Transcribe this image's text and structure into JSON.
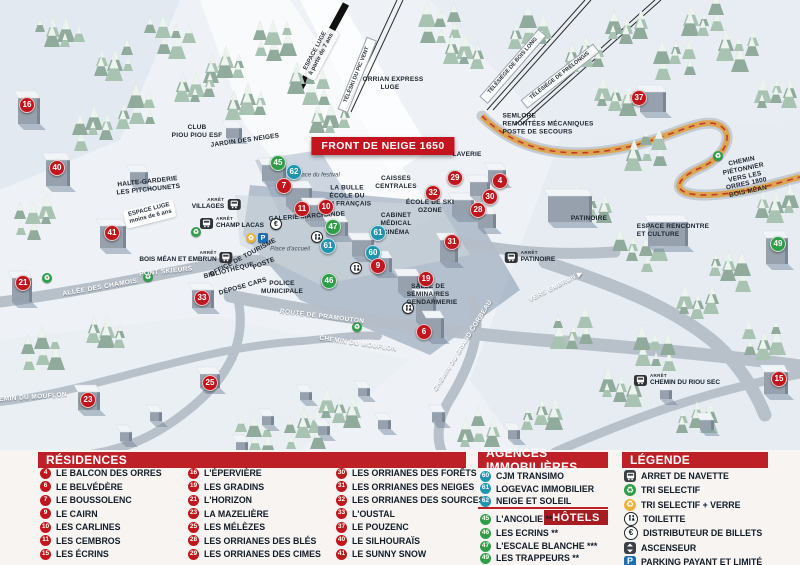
{
  "colors": {
    "red": "#c0161e",
    "green": "#2f9e49",
    "blue": "#2095ae",
    "header_red": "#bd2027",
    "banner_red": "#c41420",
    "parking_blue": "#1e6eb5",
    "trail_orange": "#dfa145"
  },
  "map": {
    "banner": "FRONT DE NEIGE 1650",
    "bus_prefix": "ARRÊT",
    "markers": [
      {
        "n": "16",
        "c": "r",
        "x": 27,
        "y": 105
      },
      {
        "n": "40",
        "c": "r",
        "x": 57,
        "y": 168
      },
      {
        "n": "41",
        "c": "r",
        "x": 112,
        "y": 233
      },
      {
        "n": "21",
        "c": "r",
        "x": 23,
        "y": 283
      },
      {
        "n": "33",
        "c": "r",
        "x": 202,
        "y": 298
      },
      {
        "n": "23",
        "c": "r",
        "x": 88,
        "y": 400
      },
      {
        "n": "25",
        "c": "r",
        "x": 210,
        "y": 383
      },
      {
        "n": "45",
        "c": "g",
        "x": 278,
        "y": 163
      },
      {
        "n": "62",
        "c": "b",
        "x": 294,
        "y": 172
      },
      {
        "n": "7",
        "c": "r",
        "x": 284,
        "y": 186
      },
      {
        "n": "11",
        "c": "r",
        "x": 302,
        "y": 209
      },
      {
        "n": "10",
        "c": "r",
        "x": 326,
        "y": 207
      },
      {
        "n": "47",
        "c": "g",
        "x": 333,
        "y": 227
      },
      {
        "n": "61",
        "c": "b",
        "x": 328,
        "y": 246
      },
      {
        "n": "61",
        "c": "b",
        "x": 378,
        "y": 233
      },
      {
        "n": "60",
        "c": "b",
        "x": 373,
        "y": 253
      },
      {
        "n": "9",
        "c": "r",
        "x": 378,
        "y": 266
      },
      {
        "n": "46",
        "c": "g",
        "x": 329,
        "y": 281
      },
      {
        "n": "19",
        "c": "r",
        "x": 426,
        "y": 279
      },
      {
        "n": "6",
        "c": "r",
        "x": 424,
        "y": 332
      },
      {
        "n": "31",
        "c": "r",
        "x": 452,
        "y": 242
      },
      {
        "n": "28",
        "c": "r",
        "x": 478,
        "y": 210
      },
      {
        "n": "29",
        "c": "r",
        "x": 455,
        "y": 178
      },
      {
        "n": "30",
        "c": "r",
        "x": 490,
        "y": 197
      },
      {
        "n": "4",
        "c": "r",
        "x": 500,
        "y": 181
      },
      {
        "n": "32",
        "c": "r",
        "x": 433,
        "y": 193
      },
      {
        "n": "37",
        "c": "r",
        "x": 639,
        "y": 98
      },
      {
        "n": "49",
        "c": "g",
        "x": 778,
        "y": 244
      },
      {
        "n": "15",
        "c": "r",
        "x": 779,
        "y": 379
      }
    ],
    "labels": [
      {
        "t": "CLUB\nPIOU PIOU ESF",
        "x": 197,
        "y": 132,
        "r": 0,
        "s": "dark"
      },
      {
        "t": "JARDIN DES NEIGES",
        "x": 245,
        "y": 141,
        "r": -8,
        "s": "dark"
      },
      {
        "t": "ESPACE LUGE\nà partir de 7 ans",
        "x": 319,
        "y": 53,
        "r": -62,
        "s": "box"
      },
      {
        "t": "ESPACE LUGE\nmoins de 6 ans",
        "x": 150,
        "y": 214,
        "r": -14,
        "s": "box"
      },
      {
        "t": "L'ORRIAN EXPRESS\nLUGE",
        "x": 390,
        "y": 84,
        "r": 0,
        "s": "dark"
      },
      {
        "t": "TÉLÉSKI DU PIC VENT",
        "x": 357,
        "y": 75,
        "r": -68,
        "s": "lift"
      },
      {
        "t": "TÉLÉSIÈGE DE BOIS LONG",
        "x": 513,
        "y": 66,
        "r": -49,
        "s": "lift"
      },
      {
        "t": "TÉLÉSIÈGE DE PRÉLONGIS",
        "x": 560,
        "y": 76,
        "r": -38,
        "s": "lift"
      },
      {
        "t": "SEMLORE\nREMONTÉES MÉCANIQUES\nPOSTE DE SECOURS",
        "x": 548,
        "y": 124,
        "r": 0,
        "s": "dark",
        "a": "left"
      },
      {
        "t": "HALTE-GARDERIE\nLES PITCHOUNETS",
        "x": 148,
        "y": 186,
        "r": -6,
        "s": "dark"
      },
      {
        "t": "LAVERIE",
        "x": 467,
        "y": 155,
        "r": 0,
        "s": "dark"
      },
      {
        "t": "CAISSES\nCENTRALES",
        "x": 396,
        "y": 183,
        "r": 0,
        "s": "dark"
      },
      {
        "t": "LA BULLE\nÉCOLE DU\nSKI FRANÇAIS",
        "x": 347,
        "y": 196,
        "r": 0,
        "s": "dark"
      },
      {
        "t": "GALERIE MARCHANDE",
        "x": 307,
        "y": 217,
        "r": -4,
        "s": "dark"
      },
      {
        "t": "ÉCOLE DE SKI\nOZONE",
        "x": 430,
        "y": 207,
        "r": 0,
        "s": "dark"
      },
      {
        "t": "CABINET\nMÉDICAL",
        "x": 396,
        "y": 220,
        "r": 0,
        "s": "dark"
      },
      {
        "t": "CINÉMA",
        "x": 396,
        "y": 233,
        "r": 0,
        "s": "dark"
      },
      {
        "t": "Place du festival",
        "x": 318,
        "y": 176,
        "r": 0,
        "s": "place"
      },
      {
        "t": "Place d'accueil",
        "x": 290,
        "y": 250,
        "r": 0,
        "s": "place"
      },
      {
        "t": "OFFICE DE TOURISME",
        "x": 243,
        "y": 258,
        "r": -28,
        "s": "dark"
      },
      {
        "t": "BIBLIOTHÈQUE",
        "x": 229,
        "y": 271,
        "r": -14,
        "s": "dark"
      },
      {
        "t": "POSTE",
        "x": 264,
        "y": 264,
        "r": -22,
        "s": "dark"
      },
      {
        "t": "DÉPOSE CARS",
        "x": 243,
        "y": 287,
        "r": -16,
        "s": "dark"
      },
      {
        "t": "POLICE\nMUNICIPALE",
        "x": 282,
        "y": 288,
        "r": 0,
        "s": "dark"
      },
      {
        "t": "SALLE DE\nSÉMINAIRES",
        "x": 428,
        "y": 291,
        "r": 0,
        "s": "dark"
      },
      {
        "t": "GENDARMERIE",
        "x": 432,
        "y": 303,
        "r": 0,
        "s": "dark"
      },
      {
        "t": "PATINOIRE",
        "x": 589,
        "y": 219,
        "r": 0,
        "s": "dark"
      },
      {
        "t": "ESPACE RENCONTRE\nET CULTURE",
        "x": 673,
        "y": 231,
        "r": 0,
        "s": "dark",
        "a": "left"
      },
      {
        "t": "ALLÉE DES CHAMOIS",
        "x": 100,
        "y": 288,
        "r": -10,
        "s": "road"
      },
      {
        "t": "PONT SKIEURS",
        "x": 166,
        "y": 272,
        "r": -6,
        "s": "road"
      },
      {
        "t": "ROUTE DE PRAMOUTON",
        "x": 322,
        "y": 317,
        "r": 7,
        "s": "road"
      },
      {
        "t": "CHEMIN DU MOUFLON",
        "x": 28,
        "y": 398,
        "r": -4,
        "s": "road"
      },
      {
        "t": "CHEMIN DU MOUFLON",
        "x": 358,
        "y": 344,
        "r": 8,
        "s": "road"
      },
      {
        "t": "CHEMIN DU GRAND CORBEAU",
        "x": 463,
        "y": 346,
        "r": -58,
        "s": "road"
      },
      {
        "t": "VERS EMBRUN ▶",
        "x": 556,
        "y": 287,
        "r": -27,
        "s": "road"
      },
      {
        "t": "CHEMIN PIÉTONNIER\nVERS LES ORRES 1800\nBOIS MÉAN",
        "x": 745,
        "y": 177,
        "r": -12,
        "s": "dark"
      }
    ],
    "bus_stops": [
      {
        "t": "VILLAGES",
        "x": 216,
        "y": 204,
        "side": "left"
      },
      {
        "t": "CHAMP LACAS",
        "x": 232,
        "y": 223,
        "side": "right"
      },
      {
        "t": "BOIS MÉAN ET EMBRUN",
        "x": 186,
        "y": 257,
        "side": "left"
      },
      {
        "t": "PATINOIRE",
        "x": 530,
        "y": 257,
        "side": "right"
      },
      {
        "t": "CHEMIN DU RIOU SEC",
        "x": 677,
        "y": 380,
        "side": "right"
      }
    ],
    "icons": [
      {
        "k": "parking",
        "x": 263,
        "y": 238
      },
      {
        "k": "verre",
        "x": 251,
        "y": 238
      },
      {
        "k": "euro",
        "x": 276,
        "y": 224
      },
      {
        "k": "wc",
        "x": 317,
        "y": 237
      },
      {
        "k": "wc",
        "x": 356,
        "y": 268
      },
      {
        "k": "wc",
        "x": 408,
        "y": 308
      },
      {
        "k": "recycle",
        "x": 196,
        "y": 232
      },
      {
        "k": "recycle",
        "x": 148,
        "y": 277
      },
      {
        "k": "recycle",
        "x": 47,
        "y": 278
      },
      {
        "k": "recycle",
        "x": 357,
        "y": 327
      },
      {
        "k": "recycle",
        "x": 718,
        "y": 156
      }
    ]
  },
  "legend": {
    "residences": {
      "title": "RÉSIDENCES",
      "items": [
        {
          "n": "4",
          "label": "LE BALCON DES ORRES"
        },
        {
          "n": "6",
          "label": "LE BELVÉDÈRE"
        },
        {
          "n": "7",
          "label": "LE BOUSSOLENC"
        },
        {
          "n": "9",
          "label": "LE CAIRN"
        },
        {
          "n": "10",
          "label": "LES CARLINES"
        },
        {
          "n": "11",
          "label": "LES CEMBROS"
        },
        {
          "n": "15",
          "label": "LES ÉCRINS"
        },
        {
          "n": "16",
          "label": "L'ÉPERVIÈRE"
        },
        {
          "n": "19",
          "label": "LES GRADINS"
        },
        {
          "n": "21",
          "label": "L'HORIZON"
        },
        {
          "n": "23",
          "label": "LA MAZELIÈRE"
        },
        {
          "n": "25",
          "label": "LES MÉLÈZES"
        },
        {
          "n": "28",
          "label": "LES ORRIANES DES BLÉS"
        },
        {
          "n": "29",
          "label": "LES ORRIANES DES CIMES"
        },
        {
          "n": "30",
          "label": "LES ORRIANES DES FORÊTS"
        },
        {
          "n": "31",
          "label": "LES ORRIANES DES NEIGES"
        },
        {
          "n": "32",
          "label": "LES ORRIANES DES SOURCES"
        },
        {
          "n": "33",
          "label": "L'OUSTAL"
        },
        {
          "n": "37",
          "label": "LE POUZENC"
        },
        {
          "n": "40",
          "label": "LE SILHOURAÏS"
        },
        {
          "n": "41",
          "label": "LE SUNNY SNOW"
        }
      ]
    },
    "agences": {
      "title": "AGENCES IMMOBILIÈRES",
      "items": [
        {
          "n": "60",
          "label": "CJM TRANSIMO"
        },
        {
          "n": "61",
          "label": "LOGEVAC IMMOBILIER"
        },
        {
          "n": "62",
          "label": "NEIGE ET SOLEIL"
        }
      ]
    },
    "hotels": {
      "title": "HÔTELS",
      "items": [
        {
          "n": "45",
          "label": "L'ANCOLIE **"
        },
        {
          "n": "46",
          "label": "LES ECRINS **"
        },
        {
          "n": "47",
          "label": "L'ESCALE BLANCHE ***"
        },
        {
          "n": "49",
          "label": "LES TRAPPEURS **"
        }
      ]
    },
    "legende": {
      "title": "LÉGENDE",
      "items": [
        {
          "icon": "bus",
          "label": "ARRET DE NAVETTE"
        },
        {
          "icon": "recycle",
          "label": "TRI SELECTIF"
        },
        {
          "icon": "verre",
          "label": "TRI SELECTIF + VERRE"
        },
        {
          "icon": "wc",
          "label": "TOILETTE"
        },
        {
          "icon": "euro",
          "label": "DISTRIBUTEUR DE BILLETS"
        },
        {
          "icon": "lift",
          "label": "ASCENSEUR"
        },
        {
          "icon": "parking",
          "label": "PARKING PAYANT ET LIMITÉ"
        }
      ]
    }
  }
}
